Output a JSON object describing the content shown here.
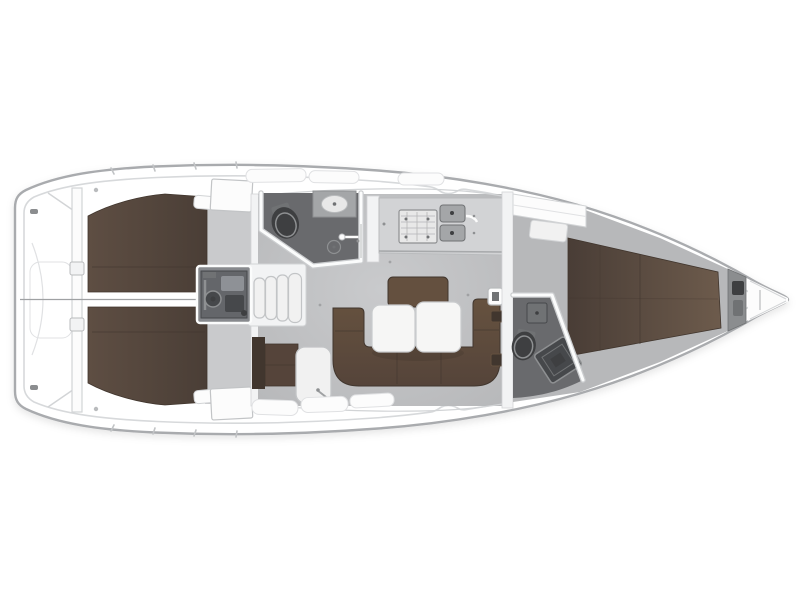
{
  "figure": {
    "kind": "sailing-yacht interior floor plan, top-down view",
    "orientation": "bow pointing right, stern (transom) at left",
    "width_px": 800,
    "height_px": 599,
    "background": "#ffffff"
  },
  "regions": [
    {
      "id": "transom-swim-platform",
      "note": "flat stern with fold lines and lockers"
    },
    {
      "id": "aft-cabin-port",
      "note": "double berth mattress, top left"
    },
    {
      "id": "aft-cabin-starboard",
      "note": "double berth mattress, bottom left"
    },
    {
      "id": "engine-compartment",
      "note": "under companionway"
    },
    {
      "id": "companionway-steps",
      "note": "four curved steps"
    },
    {
      "id": "aft-head",
      "note": "WC with toilet, basin, shower drain"
    },
    {
      "id": "galley",
      "note": "stove and double sink on counter"
    },
    {
      "id": "salon",
      "note": "U-settee with double folding table"
    },
    {
      "id": "nav-seat-and-step",
      "note": "small bench and white step box"
    },
    {
      "id": "forward-head",
      "note": "WC with toilet, shower tray, basin"
    },
    {
      "id": "forward-cabin",
      "note": "V-berth narrowing to bow"
    },
    {
      "id": "anchor-locker",
      "note": "bow tip with windlass"
    }
  ],
  "palette": {
    "hull_outline": "#a9abae",
    "deck_white": "#ffffff",
    "deck_shade": "#f2f3f4",
    "inner_line": "#d7d9db",
    "panel_fill": "#fcfcfc",
    "panel_stroke": "#e0e1e3",
    "line_soft": "#d2d4d6",
    "line_mid": "#b9bbbd",
    "floor_light": "#c9cacc",
    "floor_edge": "#b7b8ba",
    "head_floor": "#696a6d",
    "mattress_light": "#5e4e43",
    "mattress_dark": "#4a3e36",
    "berth_light": "#6d5b4c",
    "berth_dark": "#493d36",
    "settee_light": "#66523f",
    "settee_dark": "#55443a",
    "settee_line": "#41362e",
    "backrest": "#64503f",
    "counter": "#d2d3d5",
    "counter_edge": "#a7a9ab",
    "stove": "#e8e8e8",
    "stove_line": "#b4b5b7",
    "sink_gray": "#a4a6a8",
    "fixture_dark": "#3e3f41",
    "fixture_mid": "#707274",
    "fixture_rim": "#8e9092",
    "engine_frame": "#87898d",
    "engine_body": "#64666a",
    "engine_dark": "#46484b",
    "engine_lite": "#8e9196",
    "step_fill": "#f1f1f1",
    "step_stroke": "#c2c4c6",
    "wall_white": "#fbfcfc",
    "wall_gray": "#cbcdcf",
    "table_white": "#f6f6f5",
    "table_stroke": "#c9cbcd",
    "steel_band": "#8b8d8f",
    "centerline": "#9fa1a3",
    "dot_gray": "#939496"
  }
}
